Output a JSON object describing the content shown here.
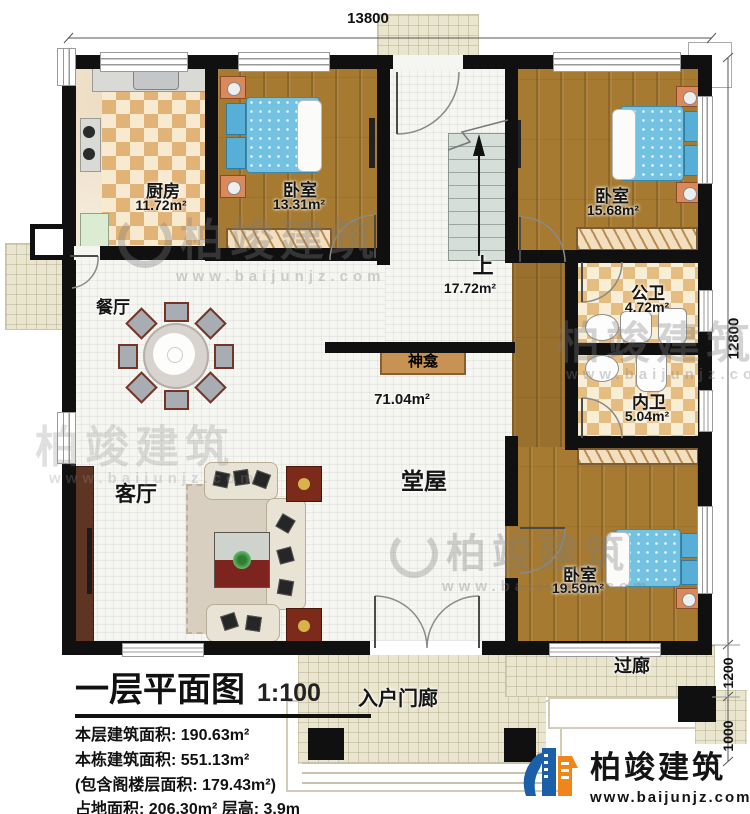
{
  "plan": {
    "dimensions": {
      "top": "13800",
      "right": "12800",
      "corridor": "1200",
      "steps": "1000"
    },
    "rooms": {
      "kitchen": {
        "label": "厨房",
        "area": "11.72m²"
      },
      "bedroom1": {
        "label": "卧室",
        "area": "13.31m²"
      },
      "bedroom2": {
        "label": "卧室",
        "area": "15.68m²"
      },
      "bedroom3": {
        "label": "卧室",
        "area": "19.59m²"
      },
      "stair_hall": {
        "label": "上",
        "area": "17.72m²"
      },
      "great_hall": {
        "label": "堂屋",
        "area": "71.04m²"
      },
      "dining": {
        "label": "餐厅"
      },
      "living": {
        "label": "客厅"
      },
      "public_bath": {
        "label": "公卫",
        "area": "4.72m²"
      },
      "private_bath": {
        "label": "内卫",
        "area": "5.04m²"
      },
      "shrine": {
        "label": "神龛"
      },
      "entry_porch": {
        "label": "入户门廊"
      },
      "corridor": {
        "label": "过廊"
      }
    },
    "title_block": {
      "title": "一层平面图",
      "scale": "1:100",
      "lines": [
        "本层建筑面积: 190.63m²",
        "本栋建筑面积: 551.13m²",
        "(包含阁楼层面积: 179.43m²)",
        "占地面积: 206.30m²  层高: 3.9m"
      ]
    },
    "brand": {
      "name": "柏竣建筑",
      "url": "www.baijunjz.com"
    },
    "watermark": {
      "text": "柏竣建筑",
      "url": "www.baijunjz.com"
    },
    "colors": {
      "wall": "#101010",
      "wood": "#a67a31",
      "checker": "#e2b376",
      "porch": "#eae5cf",
      "brand_blue": "#1a5fa8",
      "brand_orange": "#f08519"
    }
  }
}
